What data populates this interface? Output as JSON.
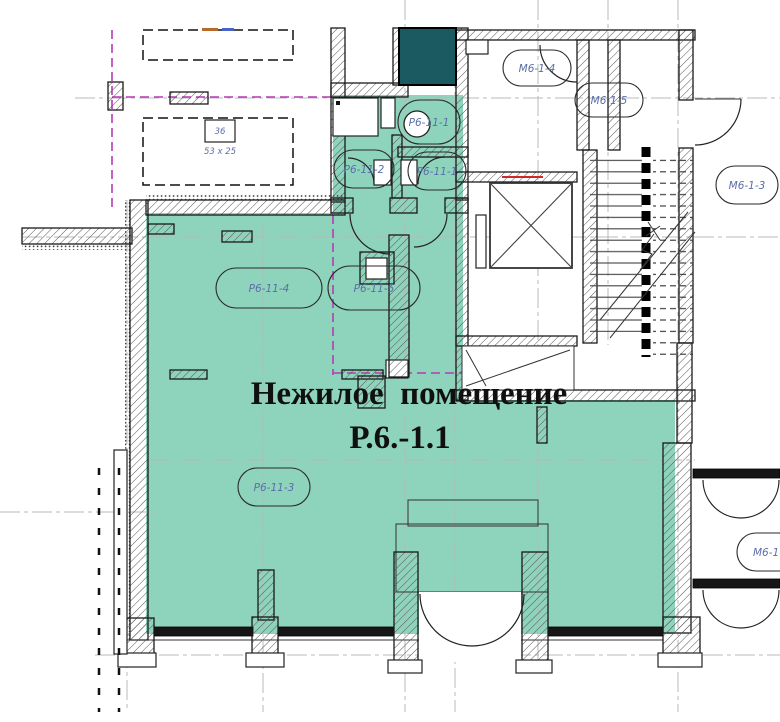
{
  "title": {
    "line1": "Нежилое  помещение",
    "line2": "Р.6.-1.1"
  },
  "rooms": [
    {
      "id": "r6-11-1a",
      "label": "Р6-11-1"
    },
    {
      "id": "r6-11-2",
      "label": "Р6-11-2"
    },
    {
      "id": "r6-11-1b",
      "label": "Р6-11-1"
    },
    {
      "id": "r6-11-4",
      "label": "Р6-11-4"
    },
    {
      "id": "r6-11-5",
      "label": "Р6-11-5"
    },
    {
      "id": "r6-11-3",
      "label": "Р6-11-3"
    },
    {
      "id": "m6-1-4",
      "label": "М6-1-4"
    },
    {
      "id": "m6-1-5",
      "label": "М6-1-5"
    },
    {
      "id": "m6-1-3",
      "label": "М6-1-3"
    },
    {
      "id": "m6-1-x",
      "label": "М6-1-"
    }
  ],
  "annotations": {
    "box_number": "36",
    "box_size": "53 х 25"
  },
  "colors": {
    "premises_fill": "#8ed3bc",
    "shaft_fill": "#1b5a60",
    "boundary_magenta": "#b63ab6",
    "alert_red": "#cc2a2a",
    "label_blue": "#5b6fa8",
    "axis_grey": "#b8b8b8"
  }
}
